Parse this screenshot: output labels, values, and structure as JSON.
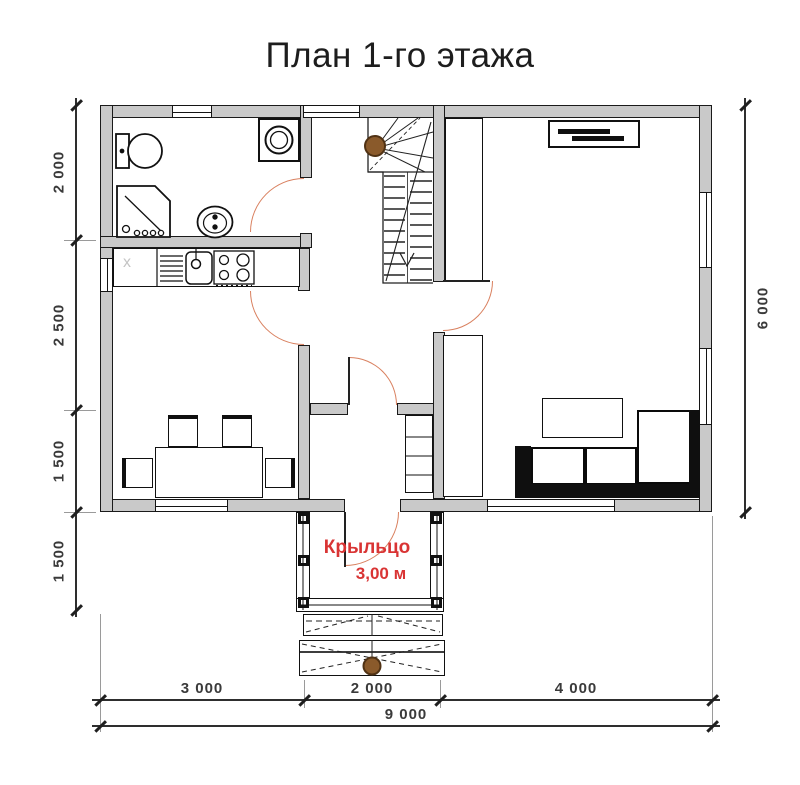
{
  "title": "План 1-го этажа",
  "dimensions": {
    "left": [
      "2 000",
      "2 500",
      "1 500",
      "1 500"
    ],
    "right": "6 000",
    "bottom_segments": [
      "3 000",
      "2 000",
      "4 000"
    ],
    "bottom_total": "9 000"
  },
  "porch": {
    "label": "Крыльцо",
    "area": "3,00 м"
  },
  "kitchen": {
    "empty_cabinet_marker": "x"
  },
  "colors": {
    "wall_fill": "#c9c9c9",
    "wall_outline": "#1a1a1a",
    "door_swing": "#d9805f",
    "porch_text": "#d93434",
    "wood_post": "#8a5a2b"
  }
}
